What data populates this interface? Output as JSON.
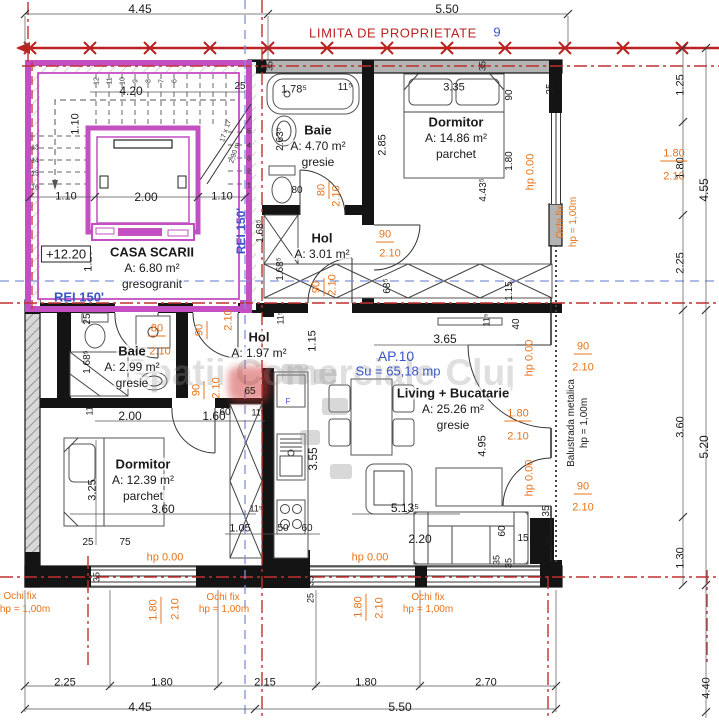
{
  "colors": {
    "boundary_red": "#bb2222",
    "annotation_orange": "#e8731a",
    "note_blue": "#3a55c8",
    "axis_blue": "#8090d8",
    "stair_magenta": "#c34fc3",
    "wall_black": "#141414"
  },
  "boundary": {
    "label": "LIMITA DE PROPRIETATE",
    "axis_number": "9"
  },
  "apartment": {
    "id": "AP.10",
    "usable_area": "Su = 65,18 mp",
    "level": "+12.20",
    "fire_rating": "REI 150'"
  },
  "watermark": {
    "text": "Spatii Comerciale Cluj"
  },
  "rooms": [
    {
      "x": 152,
      "y": 252,
      "lines": [
        "CASA SCARII",
        "A: 6.80 m²",
        "gresogranit"
      ]
    },
    {
      "x": 318,
      "y": 130,
      "lines": [
        "Baie",
        "A: 4.70 m²",
        "gresie"
      ]
    },
    {
      "x": 456,
      "y": 122,
      "lines": [
        "Dormitor",
        "A: 14.86 m²",
        "parchet"
      ]
    },
    {
      "x": 322,
      "y": 238,
      "lines": [
        "Hol",
        "A: 3.01 m²"
      ]
    },
    {
      "x": 259,
      "y": 337,
      "lines": [
        "Hol",
        "A: 1.97 m²"
      ]
    },
    {
      "x": 132,
      "y": 351,
      "lines": [
        "Baie",
        "A: 2.99 m²",
        "gresie"
      ]
    },
    {
      "x": 143,
      "y": 464,
      "lines": [
        "Dormitor",
        "A: 12.39 m²",
        "parchet"
      ]
    },
    {
      "x": 453,
      "y": 393,
      "lines": [
        "Living + Bucatarie",
        "A: 25.26 m²",
        "gresie"
      ]
    }
  ],
  "labels": {
    "red": [
      {
        "t": "LIMITA DE PROPRIETATE",
        "x": 393,
        "y": 33
      }
    ],
    "black": [
      {
        "t": "4.45",
        "x": 140,
        "y": 9,
        "s": 12
      },
      {
        "t": "5.50",
        "x": 447,
        "y": 9,
        "s": 12
      },
      {
        "t": "4.20",
        "x": 131,
        "y": 91,
        "s": 12
      },
      {
        "t": "25",
        "x": 240,
        "y": 87,
        "s": 10
      },
      {
        "t": "1.10",
        "x": 76,
        "y": 124,
        "r": -90
      },
      {
        "t": "1.10",
        "x": 66,
        "y": 197
      },
      {
        "t": "2.00",
        "x": 146,
        "y": 197,
        "s": 12
      },
      {
        "t": "1.10",
        "x": 222,
        "y": 197
      },
      {
        "t": "1.20",
        "x": 89,
        "y": 261,
        "r": -90
      },
      {
        "t": "25",
        "x": 88,
        "y": 319,
        "r": -90,
        "s": 10
      },
      {
        "t": "+12.20",
        "x": 66,
        "y": 254,
        "bx": 1,
        "n": "level-label"
      },
      {
        "t": "1.78⁵",
        "x": 294,
        "y": 90
      },
      {
        "t": "11⁵",
        "x": 345,
        "y": 88,
        "s": 10
      },
      {
        "t": "2.63⁵",
        "x": 281,
        "y": 139,
        "r": -90,
        "s": 10
      },
      {
        "t": "80",
        "x": 297,
        "y": 191,
        "s": 10
      },
      {
        "t": "1.68⁵",
        "x": 261,
        "y": 231,
        "r": -90,
        "s": 10
      },
      {
        "t": "3.35",
        "x": 454,
        "y": 88
      },
      {
        "t": "90",
        "x": 510,
        "y": 95,
        "r": -90,
        "s": 10
      },
      {
        "t": "2.85",
        "x": 383,
        "y": 145,
        "r": -90
      },
      {
        "t": "1.80",
        "x": 510,
        "y": 161,
        "r": -90,
        "s": 10
      },
      {
        "t": "4.43⁵",
        "x": 484,
        "y": 190,
        "r": -90,
        "s": 10
      },
      {
        "t": "35",
        "x": 270,
        "y": 66,
        "r": -90,
        "s": 9
      },
      {
        "t": "35",
        "x": 483,
        "y": 66,
        "r": -90,
        "s": 9
      },
      {
        "t": "35",
        "x": 551,
        "y": 89,
        "r": -90,
        "s": 10
      },
      {
        "t": "1.68⁵",
        "x": 281,
        "y": 269,
        "r": -90,
        "s": 10
      },
      {
        "t": "68⁵",
        "x": 388,
        "y": 286,
        "r": -90,
        "s": 10
      },
      {
        "t": "1.15",
        "x": 510,
        "y": 291,
        "r": -90,
        "s": 10
      },
      {
        "t": "40",
        "x": 517,
        "y": 324,
        "r": -90,
        "s": 10
      },
      {
        "t": "11⁵",
        "x": 487,
        "y": 320,
        "r": -90,
        "s": 9
      },
      {
        "t": "3.65",
        "x": 445,
        "y": 339,
        "s": 12
      },
      {
        "t": "11⁵",
        "x": 281,
        "y": 318,
        "r": -90,
        "s": 9
      },
      {
        "t": "1.15",
        "x": 313,
        "y": 341,
        "r": -90
      },
      {
        "t": "65",
        "x": 250,
        "y": 392,
        "s": 10
      },
      {
        "t": "60",
        "x": 225,
        "y": 413,
        "s": 10
      },
      {
        "t": "11⁵",
        "x": 258,
        "y": 413,
        "s": 9
      },
      {
        "t": "3.55",
        "x": 313,
        "y": 459,
        "r": -90,
        "s": 12
      },
      {
        "t": "1.68⁵",
        "x": 88,
        "y": 362,
        "r": -90,
        "s": 10
      },
      {
        "t": "11⁵",
        "x": 90,
        "y": 409,
        "r": -90,
        "s": 9
      },
      {
        "t": "2.00",
        "x": 130,
        "y": 416,
        "s": 12
      },
      {
        "t": "1.60",
        "x": 214,
        "y": 416,
        "s": 12
      },
      {
        "t": "3.25",
        "x": 93,
        "y": 490,
        "r": -90
      },
      {
        "t": "3.60",
        "x": 163,
        "y": 509,
        "s": 12
      },
      {
        "t": "25",
        "x": 88,
        "y": 543,
        "s": 10
      },
      {
        "t": "75",
        "x": 125,
        "y": 543,
        "s": 10
      },
      {
        "t": "1.05",
        "x": 240,
        "y": 529
      },
      {
        "t": "50",
        "x": 283,
        "y": 529,
        "s": 10
      },
      {
        "t": "60",
        "x": 307,
        "y": 529,
        "s": 10
      },
      {
        "t": "11⁵",
        "x": 256,
        "y": 509,
        "s": 9
      },
      {
        "t": "5.13⁵",
        "x": 405,
        "y": 508,
        "s": 12
      },
      {
        "t": "2.20",
        "x": 420,
        "y": 539,
        "s": 12
      },
      {
        "t": "60",
        "x": 503,
        "y": 531,
        "r": -90,
        "s": 10
      },
      {
        "t": "15",
        "x": 523,
        "y": 539,
        "s": 10
      },
      {
        "t": "35",
        "x": 547,
        "y": 511,
        "r": -90,
        "s": 10
      },
      {
        "t": "35",
        "x": 550,
        "y": 540,
        "r": -90,
        "s": 10
      },
      {
        "t": "4.95",
        "x": 483,
        "y": 446,
        "r": -90
      },
      {
        "t": "35",
        "x": 497,
        "y": 560,
        "r": -90,
        "s": 9
      },
      {
        "t": "35",
        "x": 509,
        "y": 563,
        "r": -90,
        "s": 9
      },
      {
        "t": "35",
        "x": 97,
        "y": 577,
        "r": -90,
        "s": 9
      },
      {
        "t": "35",
        "x": 311,
        "y": 581,
        "r": -90,
        "s": 9
      },
      {
        "t": "25",
        "x": 311,
        "y": 598,
        "r": -90,
        "s": 9
      },
      {
        "t": "1.25",
        "x": 681,
        "y": 85,
        "r": -90
      },
      {
        "t": "1.80",
        "x": 681,
        "y": 168,
        "r": -90
      },
      {
        "t": "4.55",
        "x": 704,
        "y": 190,
        "r": -90,
        "s": 12
      },
      {
        "t": "2.25",
        "x": 681,
        "y": 263,
        "r": -90
      },
      {
        "t": "3.60",
        "x": 681,
        "y": 427,
        "r": -90
      },
      {
        "t": "5.20",
        "x": 704,
        "y": 447,
        "r": -90,
        "s": 12
      },
      {
        "t": "1.30",
        "x": 681,
        "y": 558,
        "r": -90
      },
      {
        "t": "4.40",
        "x": 707,
        "y": 688,
        "r": -90
      },
      {
        "t": "2.25",
        "x": 65,
        "y": 683
      },
      {
        "t": "1.80",
        "x": 162,
        "y": 683
      },
      {
        "t": "2.15",
        "x": 265,
        "y": 683
      },
      {
        "t": "1.80",
        "x": 366,
        "y": 683
      },
      {
        "t": "2.70",
        "x": 486,
        "y": 683
      },
      {
        "t": "4.45",
        "x": 140,
        "y": 707,
        "s": 12
      },
      {
        "t": "5.50",
        "x": 400,
        "y": 707,
        "s": 12
      },
      {
        "t": "Balustrada metalica",
        "x": 572,
        "y": 423,
        "r": -90,
        "s": 10,
        "n": "railing-note"
      },
      {
        "t": "hp = 1,00m",
        "x": 585,
        "y": 423,
        "r": -90,
        "s": 10,
        "n": "railing-note"
      }
    ],
    "orange": [
      {
        "t": "1.80",
        "x": 674,
        "y": 155,
        "ft": 1
      },
      {
        "t": "2.10",
        "x": 674,
        "y": 177
      },
      {
        "t": "hp 0.00",
        "x": 531,
        "y": 172,
        "r": -90
      },
      {
        "t": "Ochi fix",
        "x": 561,
        "y": 222,
        "r": -90,
        "s": 10
      },
      {
        "t": "hp = 1,00m",
        "x": 574,
        "y": 222,
        "r": -90,
        "s": 10
      },
      {
        "t": "90",
        "x": 583,
        "y": 348,
        "ft": 1
      },
      {
        "t": "2.10",
        "x": 583,
        "y": 368
      },
      {
        "t": "90",
        "x": 583,
        "y": 488,
        "ft": 1
      },
      {
        "t": "2.10",
        "x": 583,
        "y": 508
      },
      {
        "t": "1.80",
        "x": 518,
        "y": 415,
        "ft": 1
      },
      {
        "t": "2.10",
        "x": 518,
        "y": 437
      },
      {
        "t": "hp 0.00",
        "x": 530,
        "y": 358,
        "r": -90
      },
      {
        "t": "hp 0.00",
        "x": 530,
        "y": 478,
        "r": -90
      },
      {
        "t": "80",
        "x": 323,
        "y": 190,
        "r": -90,
        "ft": 1
      },
      {
        "t": "2.10",
        "x": 337,
        "y": 196,
        "r": -90
      },
      {
        "t": "90",
        "x": 385,
        "y": 236,
        "ft": 1
      },
      {
        "t": "2.10",
        "x": 390,
        "y": 254
      },
      {
        "t": "90",
        "x": 318,
        "y": 287,
        "r": -90,
        "ft": 1
      },
      {
        "t": "2.10",
        "x": 333,
        "y": 285,
        "r": -90
      },
      {
        "t": "90",
        "x": 201,
        "y": 330,
        "r": -90,
        "ft": 1
      },
      {
        "t": "2.10",
        "x": 229,
        "y": 320,
        "r": -90
      },
      {
        "t": "80",
        "x": 157,
        "y": 330,
        "ft": 1
      },
      {
        "t": "2.10",
        "x": 160,
        "y": 352
      },
      {
        "t": "90",
        "x": 198,
        "y": 390,
        "r": -90,
        "ft": 1
      },
      {
        "t": "2.10",
        "x": 217,
        "y": 388,
        "r": -90
      },
      {
        "t": "hp 0.00",
        "x": 165,
        "y": 558
      },
      {
        "t": "hp 0.00",
        "x": 370,
        "y": 558
      },
      {
        "t": "Ochi fix",
        "x": 20,
        "y": 597,
        "s": 10
      },
      {
        "t": "hp = 1,00m",
        "x": 25,
        "y": 610,
        "s": 10
      },
      {
        "t": "1.80",
        "x": 155,
        "y": 610,
        "r": -90,
        "ft": 1
      },
      {
        "t": "2.10",
        "x": 176,
        "y": 609,
        "r": -90
      },
      {
        "t": "Ochi fix",
        "x": 223,
        "y": 598,
        "s": 10
      },
      {
        "t": "hp = 1,00m",
        "x": 224,
        "y": 610,
        "s": 10
      },
      {
        "t": "Ochi fix",
        "x": 428,
        "y": 598,
        "s": 10
      },
      {
        "t": "hp = 1,00m",
        "x": 428,
        "y": 610,
        "s": 10
      },
      {
        "t": "1.80",
        "x": 360,
        "y": 607,
        "r": -90,
        "ft": 1
      },
      {
        "t": "2.10",
        "x": 380,
        "y": 608,
        "r": -90
      }
    ],
    "blue": [
      {
        "t": "REI 150'",
        "x": 79,
        "y": 297,
        "b": 1,
        "s": 13,
        "n": "fire-rating-label"
      },
      {
        "t": "REI 150'",
        "x": 241,
        "y": 231,
        "r": -90,
        "b": 1,
        "s": 12,
        "n": "fire-rating-label"
      },
      {
        "t": "9",
        "x": 497,
        "y": 32,
        "s": 13,
        "n": "axis-number"
      },
      {
        "t": "AP.10",
        "x": 396,
        "y": 356,
        "s": 14,
        "n": "apartment-id"
      },
      {
        "t": "Su = 65,18 mp",
        "x": 398,
        "y": 371,
        "s": 13,
        "n": "apartment-area"
      },
      {
        "t": "F",
        "x": 288,
        "y": 402,
        "s": 8,
        "n": "fridge-label"
      }
    ],
    "tiny": [
      {
        "t": "12",
        "x": 97,
        "y": 81,
        "r": -90
      },
      {
        "t": "11",
        "x": 110,
        "y": 81,
        "r": -90
      },
      {
        "t": "10",
        "x": 123,
        "y": 81,
        "r": -90
      },
      {
        "t": "9",
        "x": 136,
        "y": 81,
        "r": -90
      },
      {
        "t": "8",
        "x": 149,
        "y": 81,
        "r": -90
      },
      {
        "t": "7",
        "x": 162,
        "y": 81,
        "r": -90
      },
      {
        "t": "6",
        "x": 175,
        "y": 81,
        "r": -90
      },
      {
        "t": "5",
        "x": 249,
        "y": 132
      },
      {
        "t": "4",
        "x": 249,
        "y": 146
      },
      {
        "t": "3",
        "x": 249,
        "y": 159
      },
      {
        "t": "2",
        "x": 249,
        "y": 172
      },
      {
        "t": "1",
        "x": 249,
        "y": 186
      },
      {
        "t": "13",
        "x": 35,
        "y": 148
      },
      {
        "t": "14",
        "x": 35,
        "y": 161
      },
      {
        "t": "15",
        "x": 35,
        "y": 174
      },
      {
        "t": "16",
        "x": 35,
        "y": 188
      },
      {
        "t": "17 x 17",
        "x": 226,
        "y": 131,
        "r": -72
      },
      {
        "t": "2,90 m",
        "x": 235,
        "y": 153,
        "r": -72
      }
    ]
  }
}
